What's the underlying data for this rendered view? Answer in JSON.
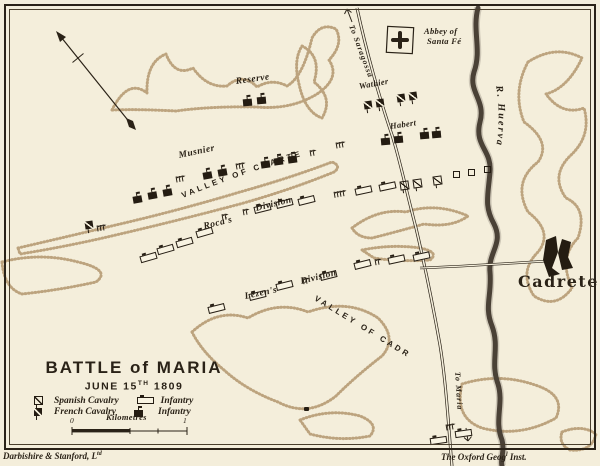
{
  "palette": {
    "background": "#f4eedb",
    "ink": "#2a2217",
    "hill_stipple": "#b3976e",
    "river": "#4b4237"
  },
  "title": {
    "line1": "BATTLE of MARIA",
    "sub_prefix": "JUNE 15",
    "sub_sup": "TH",
    "sub_suffix": "1809"
  },
  "legend": {
    "spanish_cavalry": "Spanish Cavalry",
    "french_cavalry": "French Cavalry",
    "infantry_open": "Infantry",
    "infantry_filled": "Infantry",
    "scale_label": "Kilometres",
    "scale_start": "0",
    "scale_end": "1"
  },
  "credits": {
    "left_prefix": "Darbishire & Stanford, L",
    "left_sup": "td",
    "right_prefix": "The Oxford Geog",
    "right_sup": "l",
    "right_suffix": " Inst."
  },
  "svg_labels": {
    "valley_cuarte": "VALLEY OF CUARTE",
    "valley_cadrete": "VALLEY OF CADRETE",
    "river": "R. Huerva",
    "to_saragossa": "To Saragossa",
    "to_maria": "To Maria"
  },
  "map_labels": [
    {
      "id": "reserve",
      "text": "Reserve",
      "x": 236,
      "y": 78,
      "rot": -8,
      "cls": "script"
    },
    {
      "id": "wathier",
      "text": "Wathier",
      "x": 359,
      "y": 82,
      "rot": -10,
      "cls": "script-sm"
    },
    {
      "id": "habert",
      "text": "Habert",
      "x": 390,
      "y": 122,
      "rot": -8,
      "cls": "script-sm"
    },
    {
      "id": "musnier",
      "text": "Musnier",
      "x": 179,
      "y": 152,
      "rot": -12,
      "cls": "script"
    },
    {
      "id": "rocas",
      "text": "Roca's",
      "x": 204,
      "y": 223,
      "rot": -14,
      "cls": "script"
    },
    {
      "id": "rocas-division",
      "text": "Division",
      "x": 256,
      "y": 205,
      "rot": -14,
      "cls": "script"
    },
    {
      "id": "lezens",
      "text": "Lezen's",
      "x": 245,
      "y": 293,
      "rot": -12,
      "cls": "script"
    },
    {
      "id": "lezens-division",
      "text": "Division",
      "x": 301,
      "y": 278,
      "rot": -14,
      "cls": "script"
    },
    {
      "id": "abbey-line1",
      "text": "Abbey of",
      "x": 424,
      "y": 27,
      "rot": 0,
      "cls": "script-sm"
    },
    {
      "id": "abbey-line2",
      "text": "Santa Fé",
      "x": 427,
      "y": 37,
      "rot": 0,
      "cls": "script-sm"
    },
    {
      "id": "cadrete-town",
      "text": "Cadrete",
      "x": 518,
      "y": 274,
      "rot": 0,
      "cls": "town"
    },
    {
      "id": "scale-zero",
      "text": "0",
      "x": 70,
      "y": 417,
      "rot": 0,
      "cls": "tick-num"
    },
    {
      "id": "scale-one",
      "text": "1",
      "x": 183,
      "y": 417,
      "rot": 0,
      "cls": "tick-num"
    },
    {
      "id": "kilometres",
      "text": "Kilometres",
      "x": 106,
      "y": 413,
      "rot": 0,
      "cls": "script-sm"
    }
  ],
  "units": {
    "french_infantry": [
      [
        243,
        99,
        -5
      ],
      [
        257,
        97,
        -5
      ],
      [
        133,
        196,
        -10
      ],
      [
        148,
        192,
        -10
      ],
      [
        163,
        189,
        -10
      ],
      [
        203,
        172,
        -10
      ],
      [
        218,
        169,
        -10
      ],
      [
        261,
        161,
        -8
      ],
      [
        274,
        158,
        -8
      ],
      [
        288,
        156,
        -8
      ],
      [
        381,
        138,
        -5
      ],
      [
        394,
        136,
        -5
      ],
      [
        420,
        132,
        -5
      ],
      [
        432,
        131,
        -5
      ]
    ],
    "french_cavalry": [
      [
        364,
        101,
        -8
      ],
      [
        376,
        99,
        -8
      ],
      [
        397,
        94,
        -8
      ],
      [
        409,
        92,
        -8
      ],
      [
        85,
        221,
        -8
      ]
    ],
    "spanish_cavalry": [
      [
        400,
        181,
        -8
      ],
      [
        413,
        179,
        -8
      ],
      [
        433,
        176,
        -8
      ]
    ],
    "small_squares": [
      [
        453,
        171,
        0
      ],
      [
        468,
        169,
        0
      ],
      [
        484,
        166,
        0
      ]
    ],
    "spanish_infantry": [
      [
        140,
        254,
        -16
      ],
      [
        157,
        246,
        -16
      ],
      [
        176,
        239,
        -16
      ],
      [
        196,
        229,
        -16
      ],
      [
        254,
        205,
        -14
      ],
      [
        276,
        200,
        -14
      ],
      [
        298,
        197,
        -14
      ],
      [
        355,
        187,
        -12
      ],
      [
        379,
        183,
        -12
      ],
      [
        208,
        305,
        -14
      ],
      [
        249,
        292,
        -14
      ],
      [
        276,
        282,
        -14
      ],
      [
        320,
        272,
        -14
      ],
      [
        354,
        261,
        -14
      ],
      [
        388,
        256,
        -12
      ],
      [
        413,
        253,
        -12
      ],
      [
        430,
        437,
        -8
      ],
      [
        455,
        430,
        -8
      ]
    ],
    "town_dots": [
      [
        304,
        407,
        0
      ]
    ],
    "flag_groups": [
      [
        97,
        225,
        3,
        -10
      ],
      [
        176,
        176,
        3,
        -10
      ],
      [
        236,
        163,
        3,
        -10
      ],
      [
        310,
        150,
        2,
        -10
      ],
      [
        336,
        142,
        3,
        -10
      ],
      [
        334,
        191,
        4,
        -10
      ],
      [
        222,
        214,
        2,
        -10
      ],
      [
        243,
        209,
        2,
        -10
      ],
      [
        303,
        278,
        2,
        -10
      ],
      [
        375,
        259,
        2,
        -10
      ],
      [
        446,
        424,
        3,
        -10
      ]
    ]
  }
}
